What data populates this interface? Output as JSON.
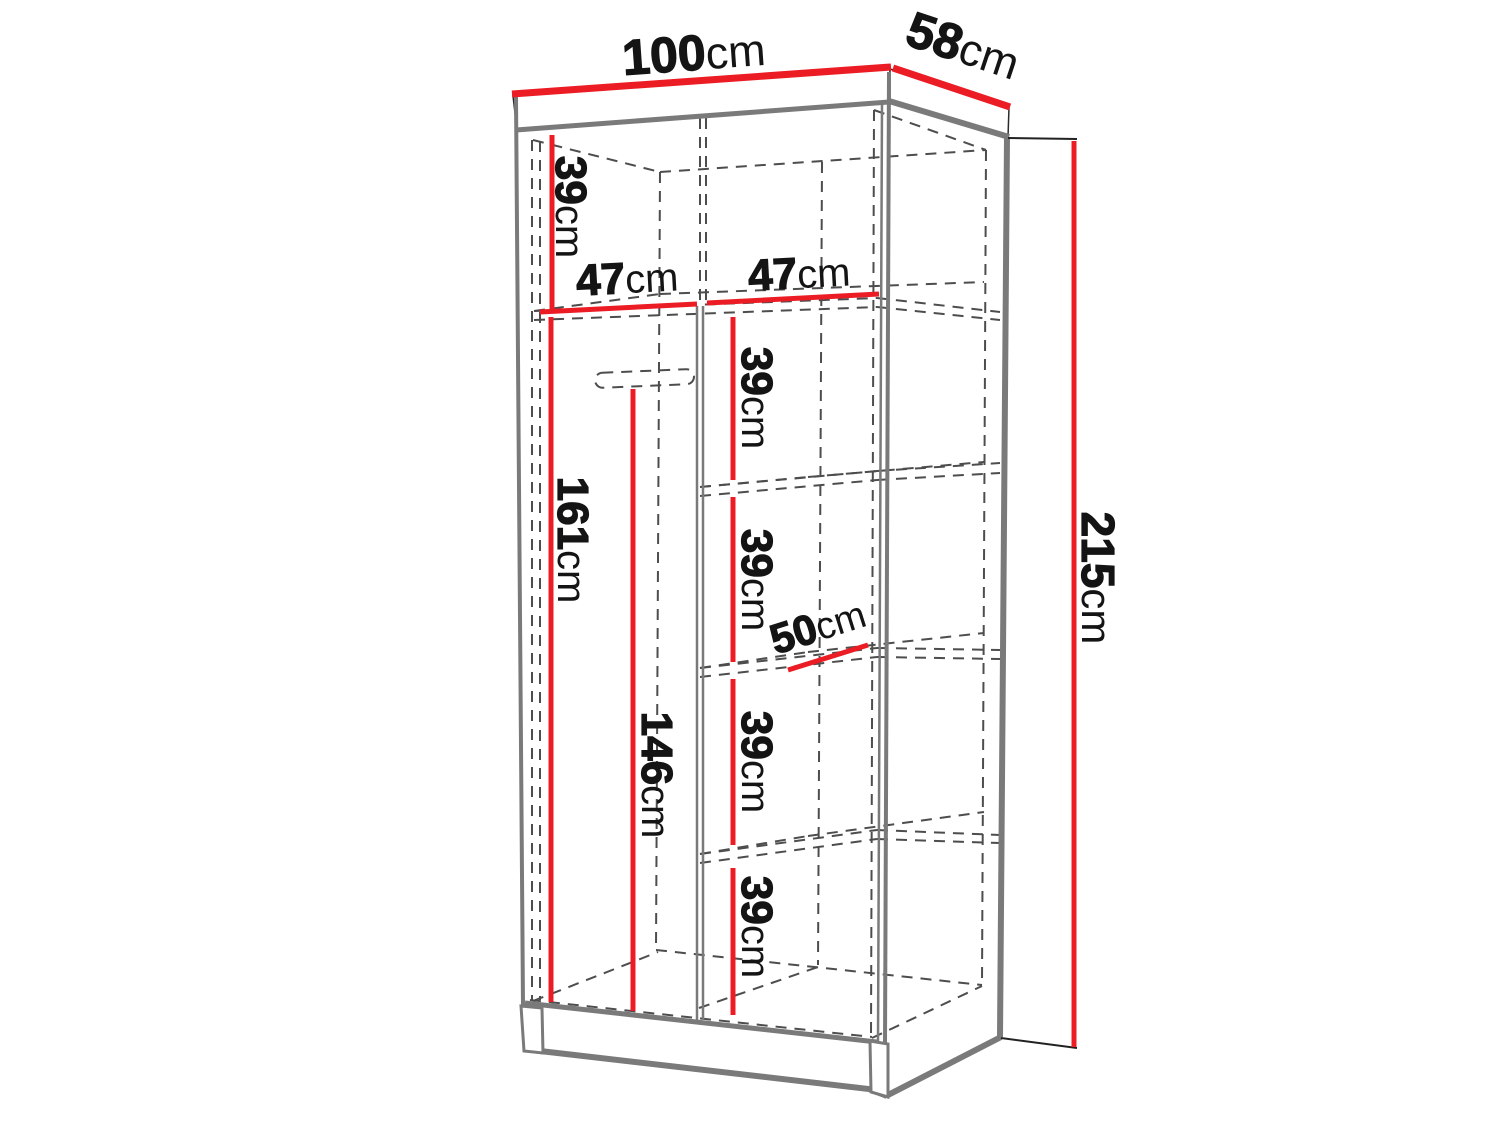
{
  "diagram": {
    "title": "wardrobe-dimension-drawing",
    "colors": {
      "dimension_red": "#ec1c24",
      "structure_gray": "#7a7a7a",
      "hidden_line_gray": "#4d4d4d",
      "outline_black": "#2b2b2b",
      "text_black": "#141414",
      "background": "#ffffff"
    },
    "labels": {
      "width": {
        "num": "100",
        "unit": "cm"
      },
      "depth": {
        "num": "58",
        "unit": "cm"
      },
      "height": {
        "num": "215",
        "unit": "cm"
      },
      "top_gap": {
        "num": "39",
        "unit": "cm"
      },
      "left_width": {
        "num": "47",
        "unit": "cm"
      },
      "right_width": {
        "num": "47",
        "unit": "cm"
      },
      "hanging_height": {
        "num": "161",
        "unit": "cm"
      },
      "rail_height": {
        "num": "146",
        "unit": "cm"
      },
      "shelf_depth": {
        "num": "50",
        "unit": "cm"
      },
      "shelf_gaps": [
        {
          "num": "39",
          "unit": "cm"
        },
        {
          "num": "39",
          "unit": "cm"
        },
        {
          "num": "39",
          "unit": "cm"
        },
        {
          "num": "39",
          "unit": "cm"
        }
      ]
    }
  }
}
